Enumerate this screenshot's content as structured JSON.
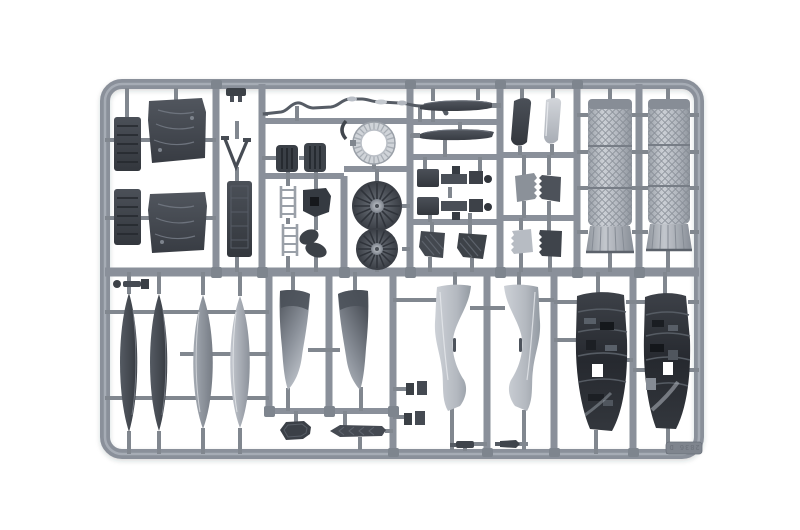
{
  "photo": {
    "description": "Top-down product photograph of a grey injection-moulded plastic model-kit sprue (parts tree) on a plain white background",
    "background_color": "#ffffff"
  },
  "sprue": {
    "marking_text": "2836 D",
    "colors": {
      "runner_grey": "#8a909a",
      "gate_grey": "#81878f",
      "plastic_dark": "#3d4148",
      "plastic_mid": "#878d96",
      "plastic_light": "#c7cbd2",
      "nozzle_light": "#b6bac1"
    },
    "layout": {
      "rows": 2,
      "frame_shape": "rounded rectangle"
    },
    "visible_parts": [
      {
        "name": "ribbed-equipment-blocks",
        "count": 4,
        "zone": "top-left"
      },
      {
        "name": "v-shaped-brace",
        "count": 1,
        "zone": "top-left"
      },
      {
        "name": "seat-back-panel",
        "count": 1,
        "zone": "top-left"
      },
      {
        "name": "boarding-ladder-sections",
        "count": 2,
        "zone": "top-middle"
      },
      {
        "name": "small-ribbed-boxes",
        "count": 2,
        "zone": "top-middle"
      },
      {
        "name": "bent-probe-tube",
        "count": 1,
        "zone": "top-center"
      },
      {
        "name": "engine-fan-ring",
        "count": 1,
        "zone": "top-center"
      },
      {
        "name": "engine-fan-discs",
        "count": 2,
        "zone": "top-center"
      },
      {
        "name": "stabilator-blades",
        "count": 2,
        "zone": "top-center-right"
      },
      {
        "name": "landing-gear-struts",
        "count": 2,
        "zone": "top-center-right"
      },
      {
        "name": "ribbed-door-panels",
        "count": 2,
        "zone": "top-center-right"
      },
      {
        "name": "curved-intake-lips",
        "count": 2,
        "zone": "top-right"
      },
      {
        "name": "serrated-access-panels",
        "count": 4,
        "zone": "top-right"
      },
      {
        "name": "afterburner-nozzle-cans",
        "count": 2,
        "zone": "top-right"
      },
      {
        "name": "long-spine-strips",
        "count": 4,
        "zone": "bottom-left"
      },
      {
        "name": "vertical-tail-fins",
        "count": 2,
        "zone": "bottom-left"
      },
      {
        "name": "octagonal-plate",
        "count": 1,
        "zone": "bottom-left"
      },
      {
        "name": "chevron-blade",
        "count": 1,
        "zone": "bottom-left"
      },
      {
        "name": "s-curved-duct-halves",
        "count": 2,
        "zone": "bottom-center"
      },
      {
        "name": "small-clip-parts",
        "count": 4,
        "zone": "bottom-center"
      },
      {
        "name": "greebled-bay-panels",
        "count": 2,
        "zone": "bottom-right"
      }
    ]
  }
}
